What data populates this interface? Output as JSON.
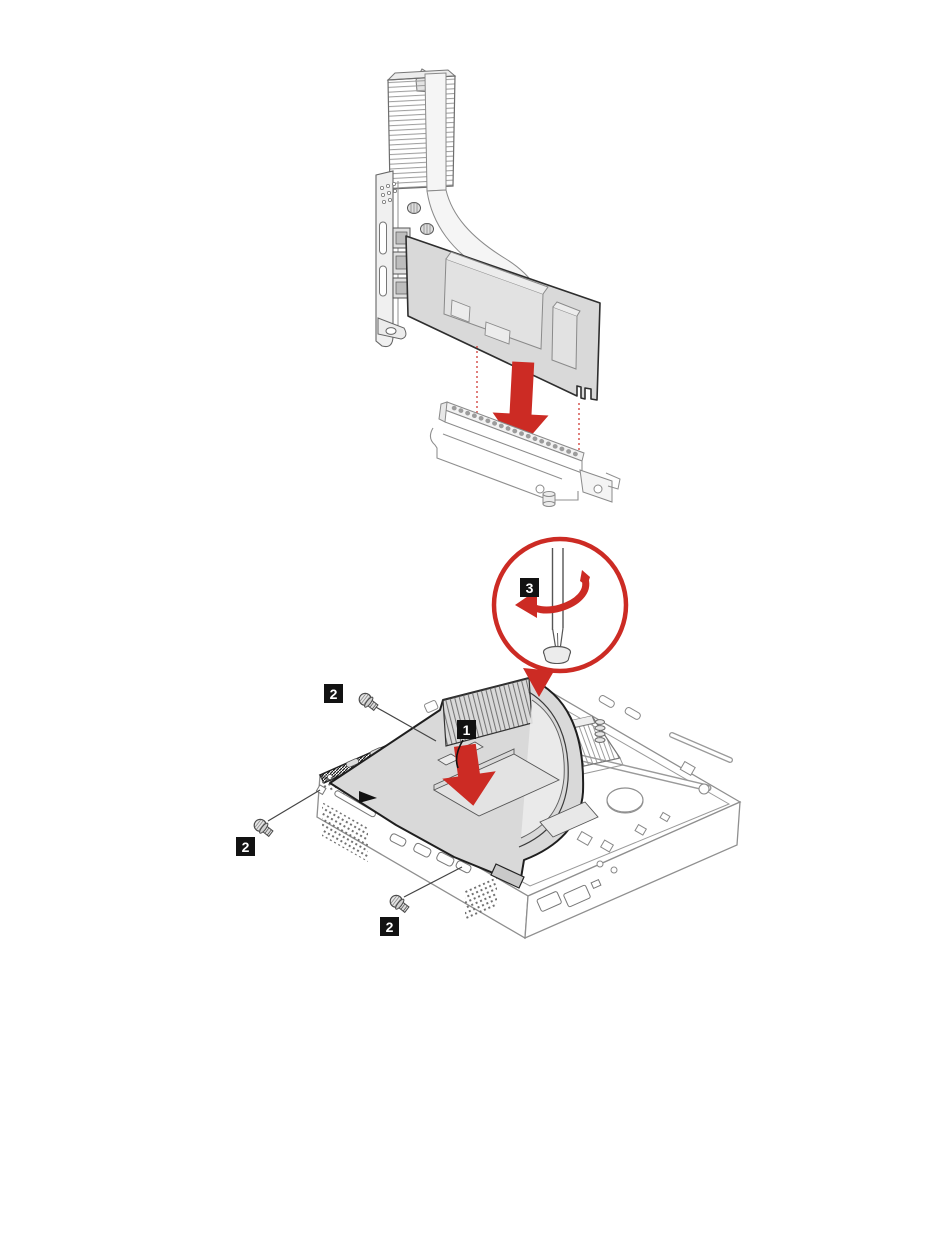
{
  "page": {
    "width": 950,
    "height": 1260,
    "background": "#ffffff"
  },
  "colors": {
    "page_bg": "#ffffff",
    "accent_red": "#cc2b24",
    "callout_bg": "#121212",
    "callout_fg": "#ffffff",
    "outline_dark": "#2e2e2e",
    "line_gray": "#8f8f8f",
    "fill_gray": "#d9d9d9"
  },
  "callouts": {
    "step1": "1",
    "step2": "2",
    "step3": "3"
  }
}
